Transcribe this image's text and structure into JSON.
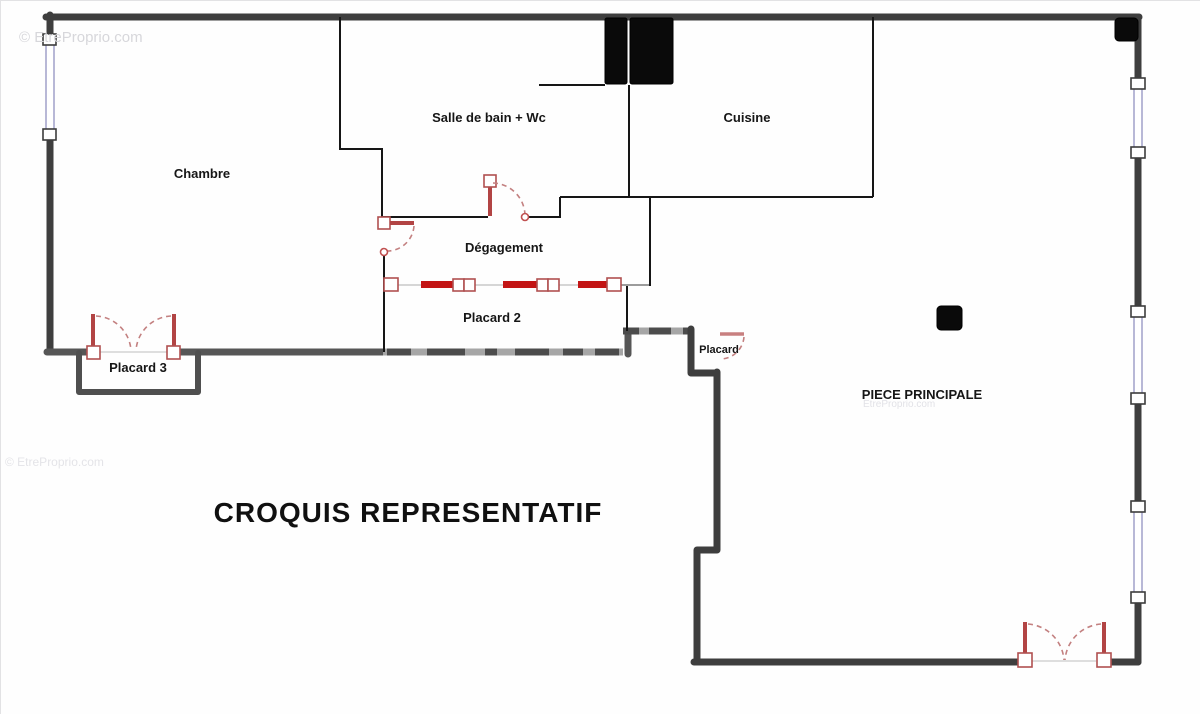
{
  "title": "CROQUIS REPRESENTATIF",
  "watermarks": {
    "top_left": "© EtreProprio.com",
    "mid_left": "© EtreProprio.com",
    "center": "EtreProprio.com"
  },
  "rooms": {
    "chambre": "Chambre",
    "salle_de_bain": "Salle de bain + Wc",
    "cuisine": "Cuisine",
    "degagement": "Dégagement",
    "placard2": "Placard 2",
    "placard3": "Placard 3",
    "placard": "Placard",
    "piece_principale": "PIECE PRINCIPALE"
  },
  "colors": {
    "wall-dark": "#3e3e3e",
    "wall-thin": "#161616",
    "wall-gray": "#a6a6a6",
    "wall-gray-dash": "#4c4c4c",
    "door-red": "#b24444",
    "door-bright": "#c31515",
    "door-arc": "#c38080",
    "window-blue": "#9a9ac6",
    "box-black": "#0a0a0a",
    "label": "#161616",
    "watermark": "#d7d7db"
  }
}
